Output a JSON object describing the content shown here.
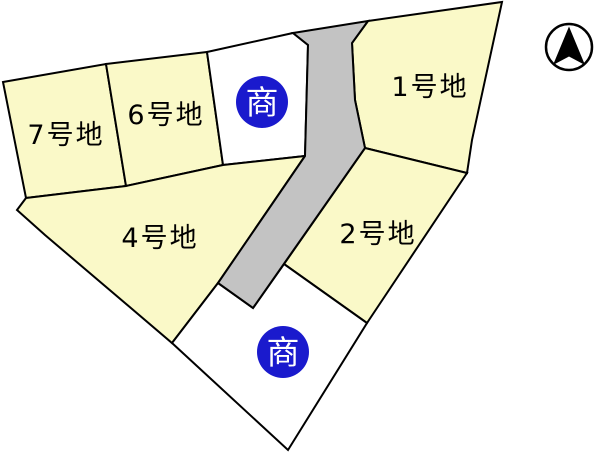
{
  "plan": {
    "type": "lot-subdivision-plan",
    "lots": {
      "lot1": {
        "label": "1号地",
        "status": "available"
      },
      "lot2": {
        "label": "2号地",
        "status": "available"
      },
      "lot4": {
        "label": "4号地",
        "status": "available"
      },
      "lot6": {
        "label": "6号地",
        "status": "available"
      },
      "lot7": {
        "label": "7号地",
        "status": "available"
      }
    },
    "commercial_lots": {
      "badge_label": "商",
      "count": 2
    },
    "compass": {
      "direction": "north"
    }
  },
  "colors": {
    "lot_fill": "#faf9c8",
    "commercial_lot_fill": "#ffffff",
    "road_fill": "#c3c3c3",
    "badge_fill": "#1a1acd",
    "badge_text": "#ffffff",
    "outline": "#000000",
    "background": "#ffffff",
    "compass_arrow": "#000000"
  }
}
